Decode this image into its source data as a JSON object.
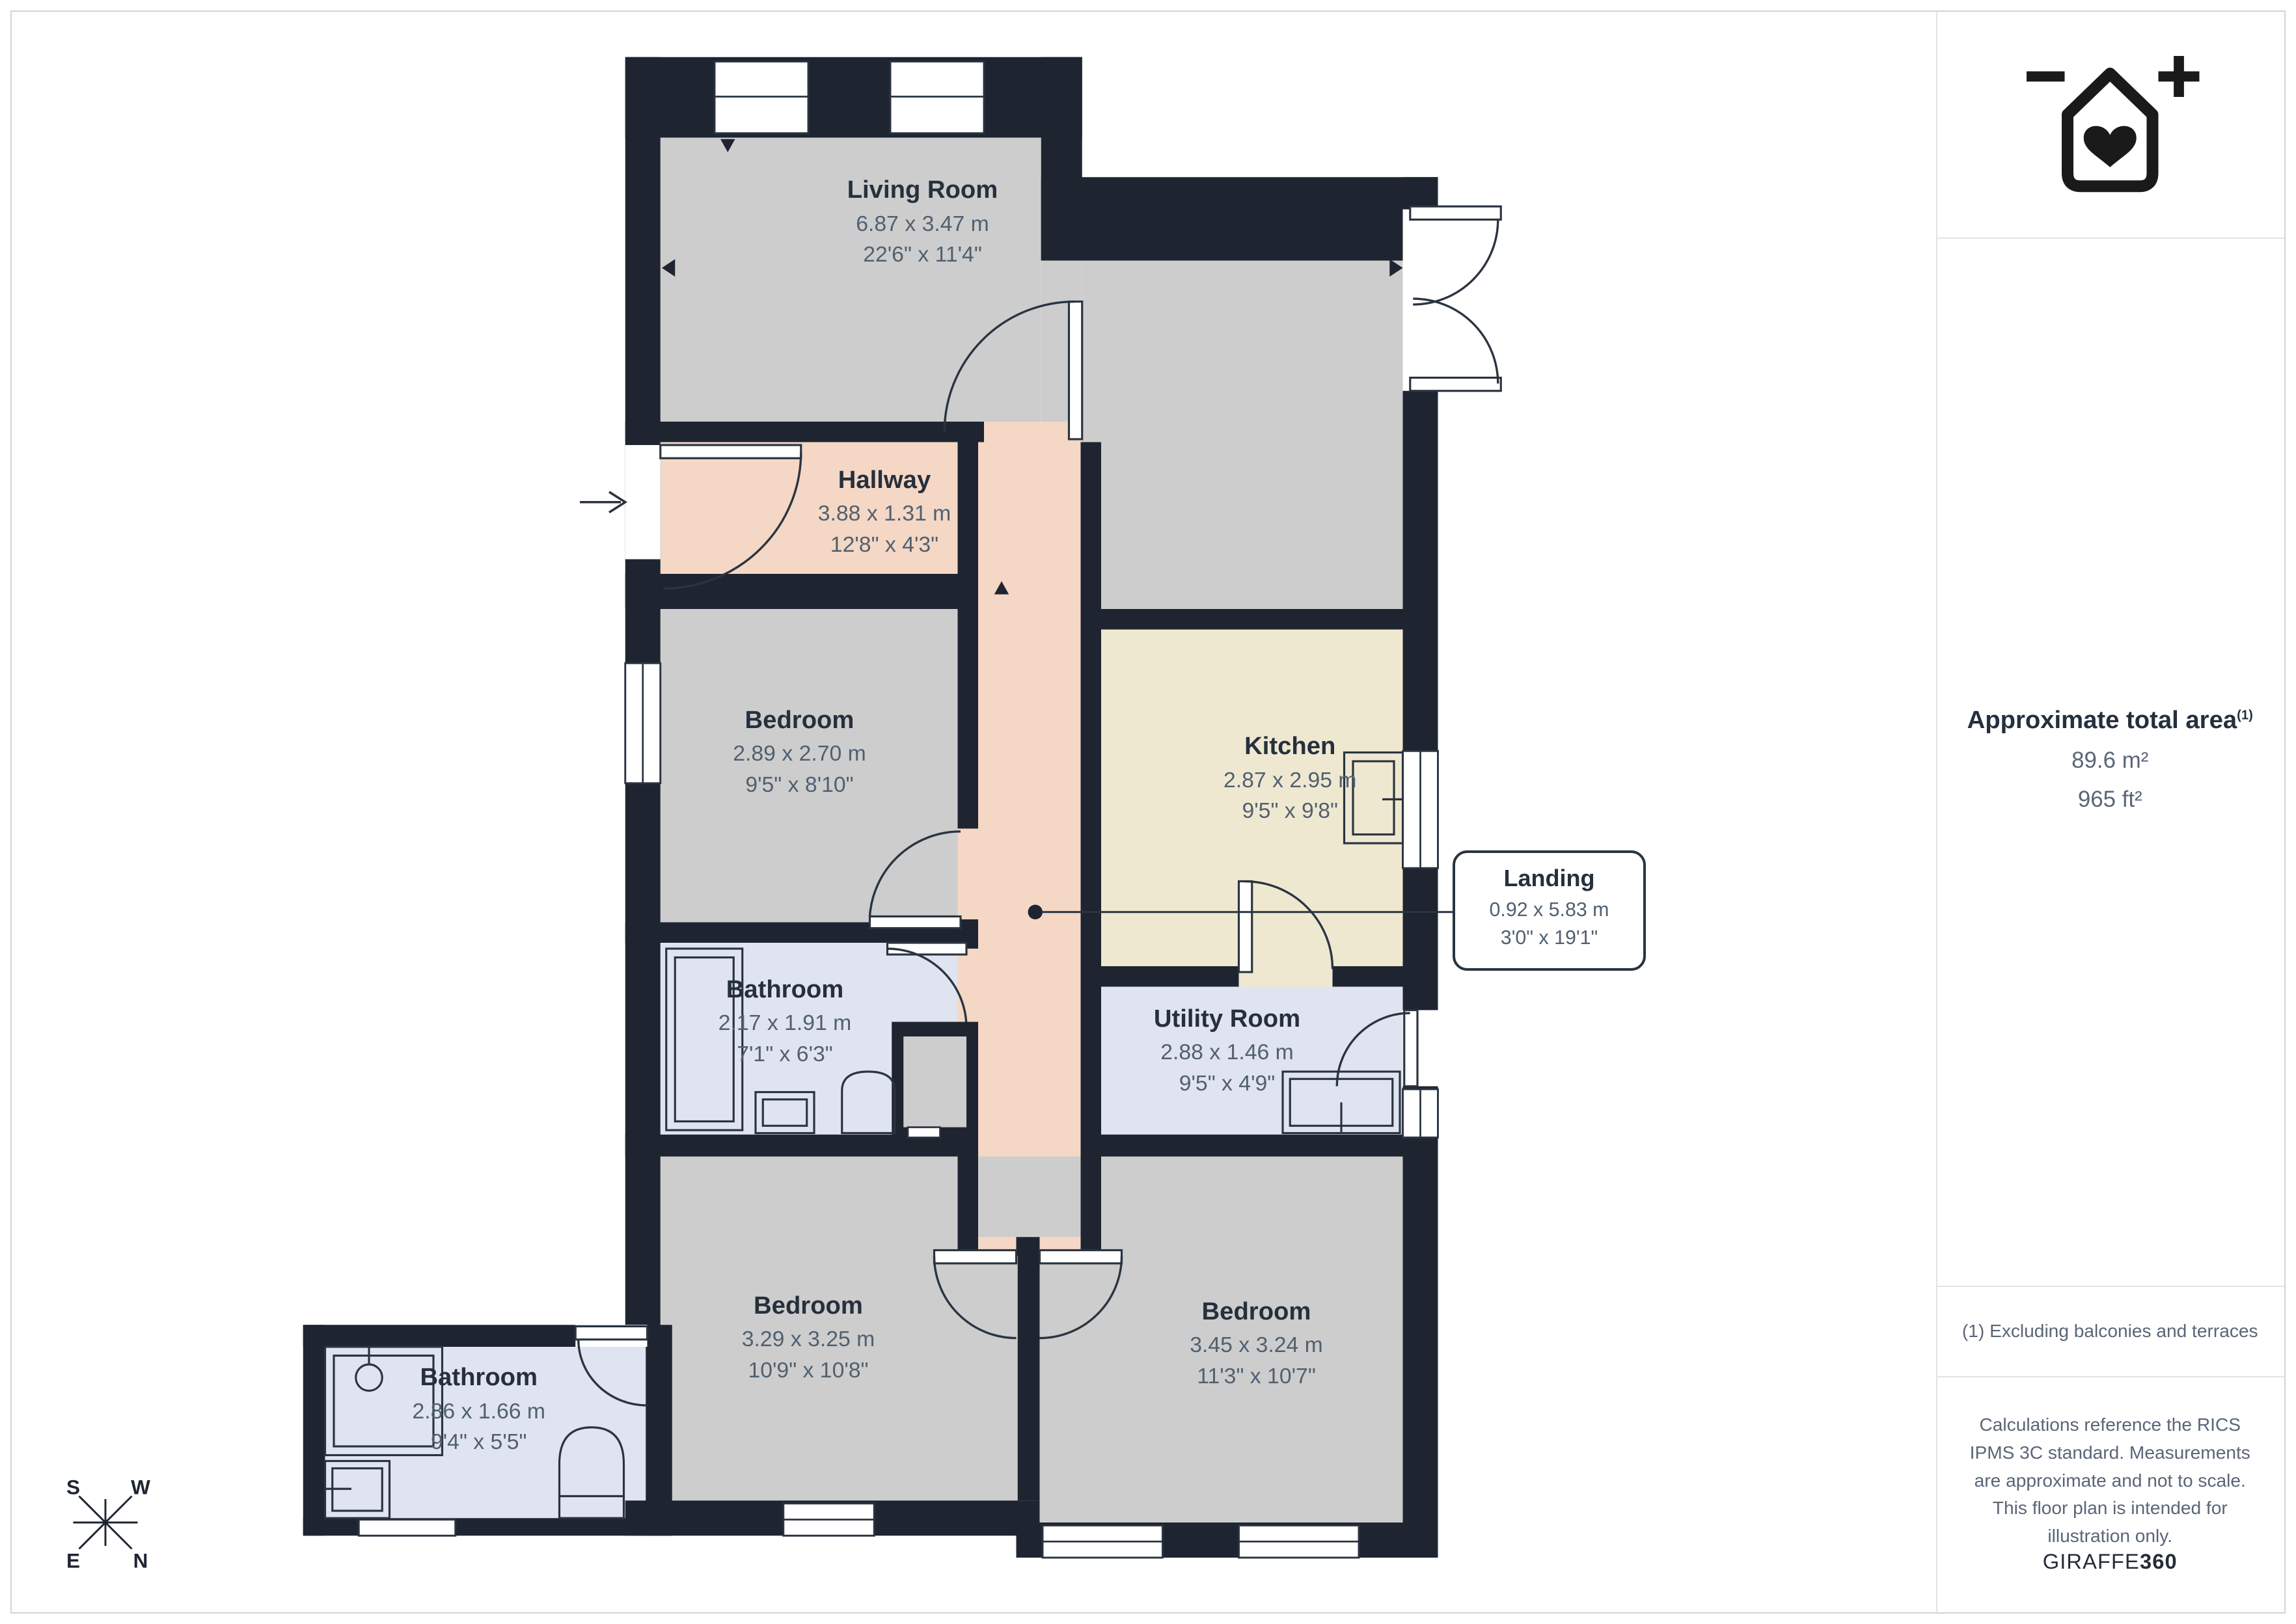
{
  "floor_plan": {
    "rooms": [
      {
        "id": "living-room",
        "name": "Living Room",
        "dimensions_m": "6.87 x 3.47 m",
        "dimensions_ft": "22'6\" x 11'4\""
      },
      {
        "id": "hallway",
        "name": "Hallway",
        "dimensions_m": "3.88 x 1.31 m",
        "dimensions_ft": "12'8\" x 4'3\""
      },
      {
        "id": "bedroom-1",
        "name": "Bedroom",
        "dimensions_m": "2.89 x 2.70 m",
        "dimensions_ft": "9'5\" x 8'10\""
      },
      {
        "id": "kitchen",
        "name": "Kitchen",
        "dimensions_m": "2.87 x 2.95 m",
        "dimensions_ft": "9'5\" x 9'8\""
      },
      {
        "id": "bathroom-1",
        "name": "Bathroom",
        "dimensions_m": "2.17 x 1.91 m",
        "dimensions_ft": "7'1\" x 6'3\""
      },
      {
        "id": "utility-room",
        "name": "Utility Room",
        "dimensions_m": "2.88 x 1.46 m",
        "dimensions_ft": "9'5\" x 4'9\""
      },
      {
        "id": "landing",
        "name": "Landing",
        "dimensions_m": "0.92 x 5.83 m",
        "dimensions_ft": "3'0\" x 19'1\""
      },
      {
        "id": "bedroom-2",
        "name": "Bedroom",
        "dimensions_m": "3.29 x 3.25 m",
        "dimensions_ft": "10'9\" x 10'8\""
      },
      {
        "id": "bedroom-3",
        "name": "Bedroom",
        "dimensions_m": "3.45 x 3.24 m",
        "dimensions_ft": "11'3\" x 10'7\""
      },
      {
        "id": "bathroom-2",
        "name": "Bathroom",
        "dimensions_m": "2.86 x 1.66 m",
        "dimensions_ft": "9'4\" x 5'5\""
      }
    ],
    "compass": {
      "top_left": "S",
      "top_right": "W",
      "bottom_left": "E",
      "bottom_right": "N"
    }
  },
  "sidebar": {
    "area_heading": "Approximate total area",
    "area_footnote_marker": "(1)",
    "area_m2": "89.6 m²",
    "area_ft2": "965 ft²",
    "footnote": "(1) Excluding balconies and terraces",
    "disclaimer": "Calculations reference the RICS IPMS 3C standard. Measurements are approximate and not to scale. This floor plan is intended for illustration only.",
    "brand": {
      "name": "GIRAFFE",
      "suffix": "360"
    }
  },
  "colors": {
    "wall": "#1E2531",
    "thin_line": "#2A3441",
    "living_bedroom_fill": "#CDCDCD",
    "hallway_landing_fill": "#F4D7C5",
    "kitchen_fill": "#EFE8D1",
    "bathroom_utility_fill": "#DFE4F0",
    "room_title_text": "#26303D",
    "room_dims_text": "#51606F",
    "sidebar_text": "#5A6577",
    "logo": "#1A1A1A"
  }
}
